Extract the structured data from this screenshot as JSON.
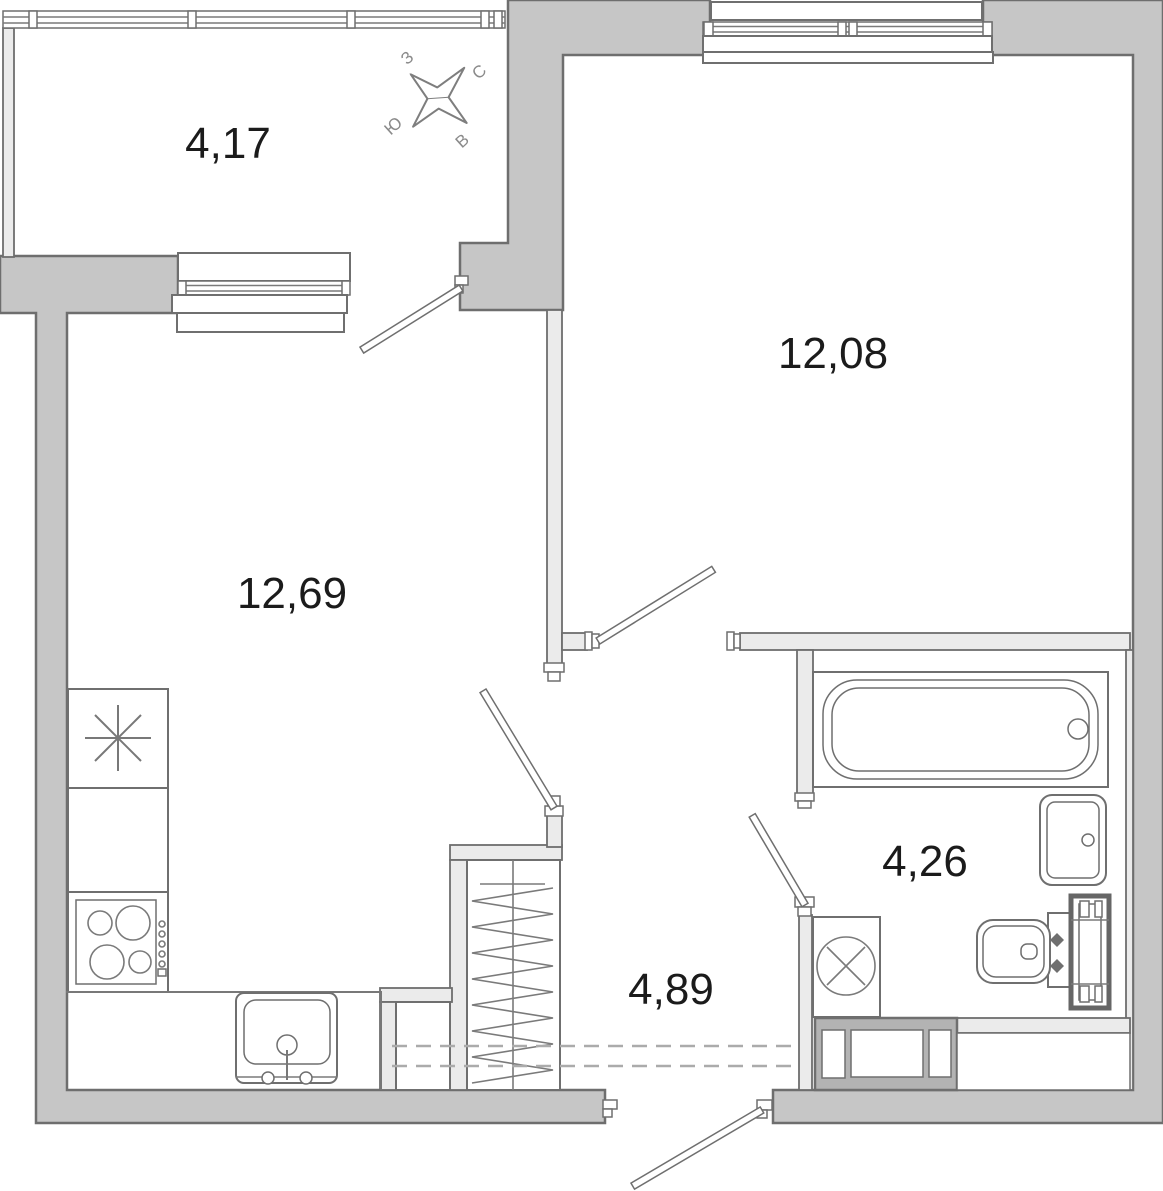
{
  "rooms": {
    "balcony": {
      "area": "4,17"
    },
    "room_right": {
      "area": "12,08"
    },
    "room_left": {
      "area": "12,69"
    },
    "hallway": {
      "area": "4,89"
    },
    "bathroom": {
      "area": "4,26"
    }
  },
  "compass": {
    "north": "С",
    "south": "Ю",
    "west": "З",
    "east": "В"
  },
  "colors": {
    "exterior_wall_fill": "#c6c6c6",
    "wall_stroke": "#6e6e6e",
    "partition_fill": "#ebebeb",
    "fixture_stroke": "#787878",
    "vent_shaft_fill": "#b3b3b3",
    "label_color": "#1b1b1b",
    "compass_color": "#8a8a8a",
    "dashed_line_color": "#ababab"
  }
}
